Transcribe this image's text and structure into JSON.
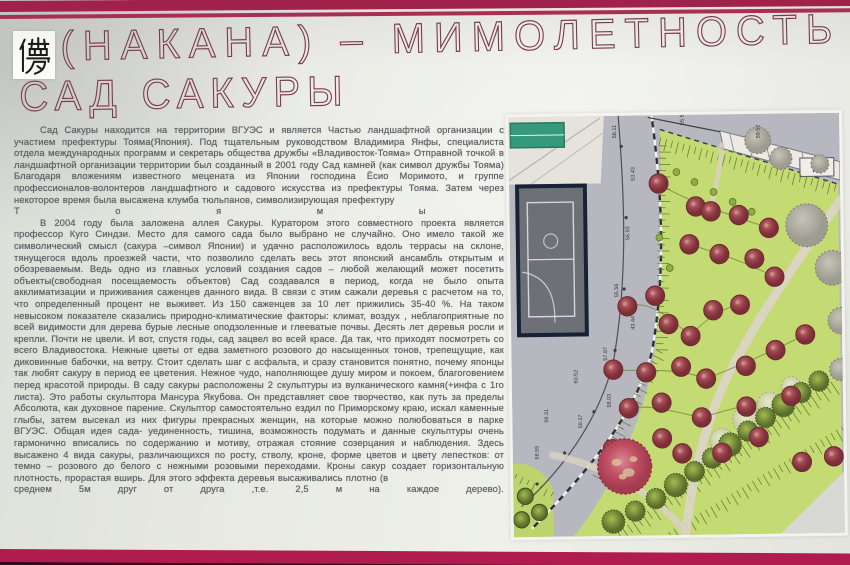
{
  "header": {
    "kanji": "儚",
    "title": "(НАКАНА) – МИМОЛЕТНОСТЬ",
    "subtitle": "САД САКУРЫ"
  },
  "colors": {
    "stripe_top": "#a82350",
    "stripe_bottom": "#b01c4e",
    "title_text": "#7b3c4f",
    "paper": "#e9eae4",
    "body_text": "#5f6066",
    "lawn": "#c4da72",
    "road": "#b7b8bf",
    "sakura": "#a34b53",
    "big_sakura": "#c15064",
    "shrub": "#6b7f35",
    "teal_building": "#35997c",
    "sports_court": "#6e7077"
  },
  "article": {
    "paragraph1": "Сад Сакуры  находится на территории ВГУЭС и является Частью ландшафтной организации с участием префектуры Тояма(Япония). Под тщательным руководством Владимира Янфы, специалиста отдела международных программ и секретарь общества дружбы «Владивосток-Тояма» Отправной точкой в ландшафтной организации территории был созданный в 2001 году Сад камней (как символ дружбы Тояма) Благодаря вложениям известного мецената из Японии господина Ёсио Моримото, и группе профессионалов-волонтеров ландшафтного и садового искусства из префектуры Тояма. Затем через некоторое время была высажена клумба тюльпанов, символизирующая префектуру",
    "spread_word_letters": [
      "Т",
      "о",
      "я",
      "м",
      "ы"
    ],
    "paragraph2": "В 2004 году была заложена аллея Сакуры.  Куратором этого совместного проекта является профессор Куго Синдзи. Место для самого сада было выбрано не случайно. Оно имело такой же символический смысл (сакура –символ Японии) и удачно расположилось вдоль террасы на склоне, тянущегося вдоль проезжей части, что позволило сделать весь этот японский ансамбль открытым и обозреваемым. Ведь одно из главных условий создания садов – любой желающий может посетить объекты(свободная посещаемость объектов) Сад создавался в период, когда не было опыта акклиматизации и приживания саженцев данного вида. В связи с этим сажали деревья с расчетом на то, что определенный процент не выживет. Из 150 саженцев за 10 лет прижились 35-40 %. На таком невысоком показателе сказались природно-климатические факторы: климат, воздух , неблагоприятные по всей видимости для дерева бурые лесные оподзоленные и глееватые почвы. Десять лет деревья росли и крепли. Почти не цвели. И вот, спустя годы, сад зацвел во всей красе. Да так, что приходят посмотреть со всего Владивостока. Нежные цветы от едва заметного розового до насыщенных тонов, трепещущие, как диковинные бабочки, на ветру. Стоит сделать шаг с асфальта, и сразу становится понятно, почему японцы так любят сакуру в период ее цветения. Нежное чудо, наполняющее душу миром и покоем, благоговением перед красотой природы. В саду сакуры расположены 2 скульптуры  из вулканического камня(+инфа с 1го листа). Это работы скульптора Мансура Якубова. Он  представляет свое творчество, как путь за пределы Абсолюта, как духовное парение. Скульптор самостоятельно ездил по Приморскому краю, искал каменные глыбы, затем высекал из них фигуры прекрасных женщин, на которые можно полюбоваться в парке ВГУЭС. Общая идея сада- уединенность, тишина, возможность подумать и данные  скульптуры очень гармонично вписались по содержанию и мотиву, отражая стояние созерцания и наблюдения. Здесь высажено 4 вида сакуры, различающихся по росту, стволу, кроне, форме цветов и цвету лепестков: от темно – розового до белого с нежными розовыми переходами. Кроны сакур создает горизонтальную плотность, прорастая вширь. Для этого эффекта деревья высаживались плотно (в",
    "last_line_words": [
      "среднем",
      "5м",
      "друг",
      "от",
      "друга",
      ",т.е.",
      "2,5",
      "м",
      "на",
      "каждое",
      "дерево)."
    ]
  },
  "map": {
    "arrow": "►",
    "elevation_labels": [
      {
        "v": "58.11",
        "x": 108,
        "y": 22
      },
      {
        "v": "53.43",
        "x": 126,
        "y": 64
      },
      {
        "v": "56.93",
        "x": 120,
        "y": 122
      },
      {
        "v": "55.56",
        "x": 108,
        "y": 178
      },
      {
        "v": "43.44",
        "x": 124,
        "y": 210
      },
      {
        "v": "57.87",
        "x": 96,
        "y": 240
      },
      {
        "v": "58.03",
        "x": 99,
        "y": 286
      },
      {
        "v": "60.52",
        "x": 66,
        "y": 262
      },
      {
        "v": "59.37",
        "x": 70,
        "y": 306
      },
      {
        "v": "59.31",
        "x": 36,
        "y": 300
      },
      {
        "v": "58.55",
        "x": 26,
        "y": 336
      },
      {
        "v": "55.50",
        "x": 176,
        "y": 10
      },
      {
        "v": "59.52",
        "x": 252,
        "y": 24
      }
    ],
    "sakura_trees": [
      [
        150,
        67
      ],
      [
        187,
        90
      ],
      [
        202,
        95
      ],
      [
        230,
        99
      ],
      [
        260,
        112
      ],
      [
        180,
        127
      ],
      [
        210,
        137
      ],
      [
        245,
        142
      ],
      [
        265,
        160
      ],
      [
        117,
        187
      ],
      [
        145,
        177
      ],
      [
        158,
        205
      ],
      [
        180,
        217
      ],
      [
        203,
        192
      ],
      [
        230,
        187
      ],
      [
        102,
        249
      ],
      [
        135,
        252
      ],
      [
        170,
        247
      ],
      [
        195,
        259
      ],
      [
        235,
        247
      ],
      [
        265,
        232
      ],
      [
        295,
        217
      ],
      [
        117,
        287
      ],
      [
        150,
        282
      ],
      [
        190,
        297
      ],
      [
        235,
        287
      ],
      [
        280,
        277
      ],
      [
        100,
        327
      ],
      [
        150,
        317
      ],
      [
        170,
        332
      ],
      [
        210,
        332
      ],
      [
        247,
        317
      ],
      [
        290,
        342
      ],
      [
        322,
        337
      ]
    ],
    "big_tree": {
      "x": 112,
      "y": 344,
      "r": 27
    },
    "gray_trees": [
      [
        250,
        26,
        13
      ],
      [
        273,
        44,
        11
      ],
      [
        312,
        50,
        9
      ],
      [
        298,
        110,
        21
      ],
      [
        323,
        152,
        17
      ],
      [
        331,
        204,
        13
      ],
      [
        330,
        252,
        11
      ]
    ],
    "fluffy_trees": [
      [
        210,
        320,
        12
      ],
      [
        235,
        300,
        14
      ],
      [
        258,
        285,
        12
      ],
      [
        280,
        268,
        10
      ]
    ],
    "shrub_row": [
      [
        100,
        398
      ],
      [
        122,
        388
      ],
      [
        143,
        376
      ],
      [
        163,
        363
      ],
      [
        182,
        350
      ],
      [
        200,
        337
      ],
      [
        218,
        324
      ],
      [
        236,
        311
      ],
      [
        254,
        298
      ],
      [
        272,
        286
      ],
      [
        290,
        274
      ],
      [
        308,
        263
      ]
    ],
    "corner_shrubs": [
      [
        12,
        372
      ],
      [
        26,
        388
      ],
      [
        8,
        395
      ]
    ],
    "small_shrubs": [
      [
        168,
        56
      ],
      [
        186,
        66
      ],
      [
        205,
        76
      ],
      [
        224,
        86
      ],
      [
        243,
        96
      ],
      [
        150,
        120
      ],
      [
        160,
        150
      ],
      [
        148,
        176
      ]
    ]
  }
}
